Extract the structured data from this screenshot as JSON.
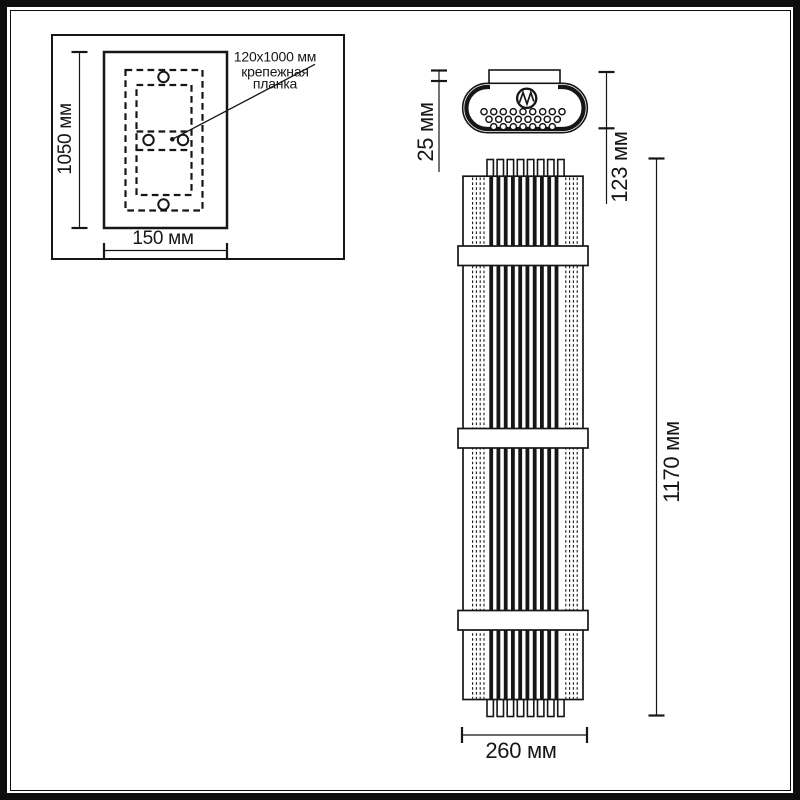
{
  "inset": {
    "plate_height_label": "1050 мм",
    "plate_width_label": "150 мм",
    "callout": {
      "size": "120x1000 мм",
      "name_line1": "крепежная",
      "name_line2": "планка"
    }
  },
  "top_view": {
    "bracket_depth_label": "25 мм",
    "fixture_depth_label": "123 мм"
  },
  "front_view": {
    "height_label": "1170 мм",
    "width_label": "260 мм"
  },
  "colors": {
    "line": "#161616",
    "background": "#ffffff"
  }
}
